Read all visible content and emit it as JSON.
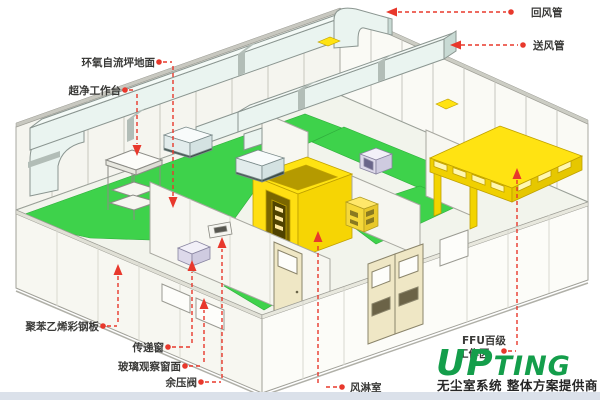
{
  "page": {
    "background": "#ffffff",
    "footer_bar_color": "#dbe1ea"
  },
  "callouts": {
    "return_duct": "回风管",
    "supply_duct": "送风管",
    "epoxy_floor": "环氧自流坪地面",
    "clean_bench": "超净工作台",
    "sandwich_panel": "聚苯乙烯彩钢板",
    "pass_window": "传递窗",
    "observation_window": "玻璃观察窗面",
    "pressure_relief_valve": "余压阀",
    "air_shower": "风淋室",
    "ffu_area_line1": "FFU百级",
    "ffu_area_line2": "工作区"
  },
  "logo": {
    "brand": "UPTING",
    "brand_prefix": "UP",
    "brand_suffix": "TING",
    "tagline": "无尘室系统 整体方案提供商",
    "brand_color": "#149e4b"
  },
  "watermark": "UPTING",
  "colors": {
    "floor_green": "#3ed24b",
    "highlight_yellow": "#ffe312",
    "callout_red": "#e8382c",
    "duct_fill": "#eaf4f0",
    "duct_end": "#c8dad4",
    "wall_fill": "#f7f7f1",
    "door_fill": "#efe7c5",
    "kick_plate": "#6b6347"
  }
}
